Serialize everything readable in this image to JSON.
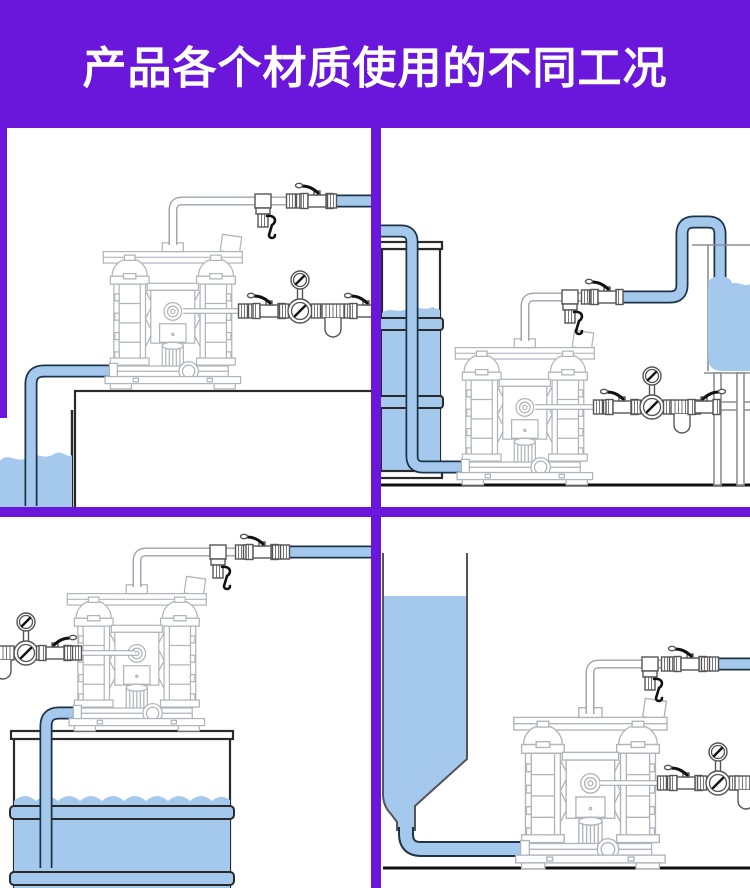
{
  "header": {
    "title": "产品各个材质使用的不同工况"
  },
  "colors": {
    "header_bg": "#6b16db",
    "divider": "#6b16db",
    "liquid": "#a5c9ed",
    "pipe_outline": "#1d3348",
    "lineart": "#afb5bb",
    "hardware": "#555555",
    "dark": "#111111",
    "tank_stroke": "#2a2a2a",
    "stand_stroke": "#8a8f94",
    "floor": "#111111"
  }
}
